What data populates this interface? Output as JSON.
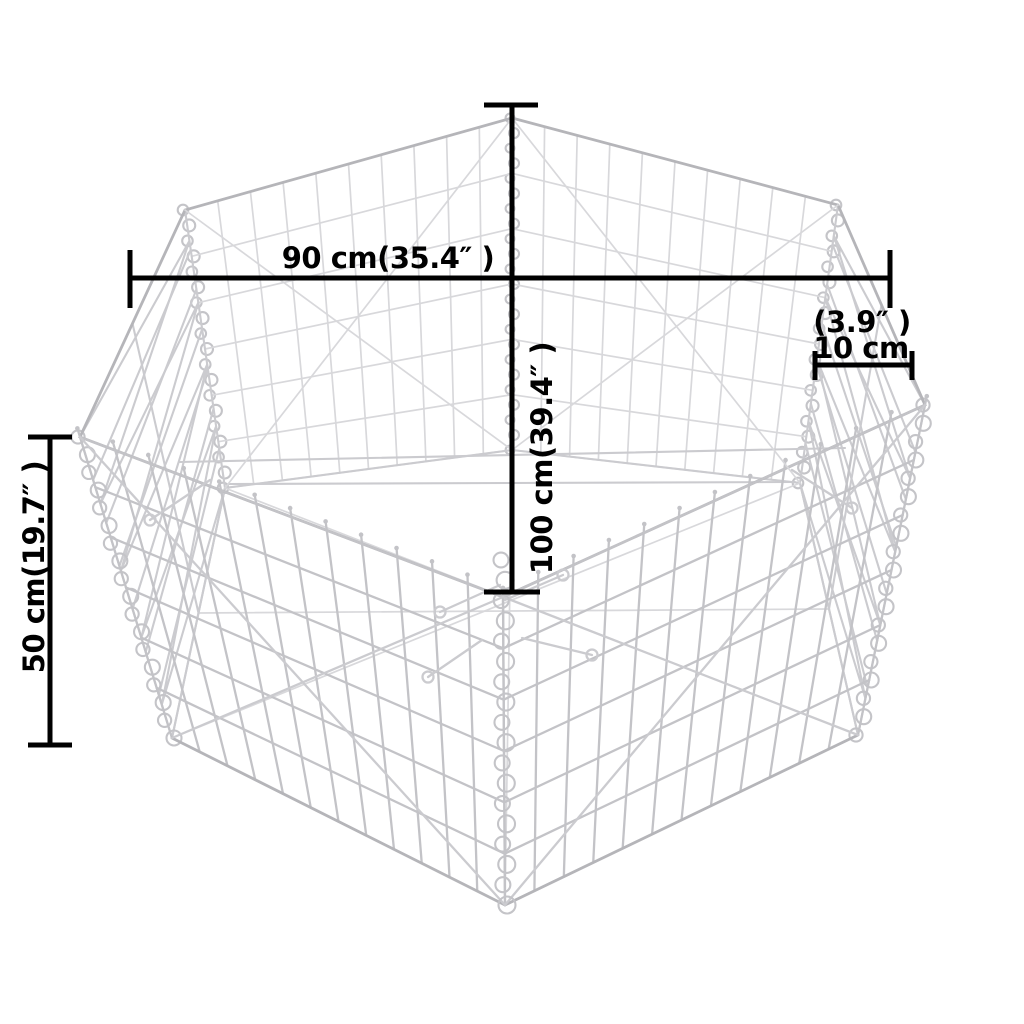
{
  "figure": {
    "type": "product-dimension-diagram",
    "subject": "hexagonal-gabion-wire-mesh-basket",
    "background_color": "#ffffff",
    "wire_color_near": "#c3c3c7",
    "wire_color_mid": "#cbcbcf",
    "wire_color_far": "#d8d8db",
    "wire_color_rim": "#b5b5b9",
    "spiral_color": "#c4c4c8",
    "dimension_color": "#000000"
  },
  "dimensions": {
    "width": {
      "label": "90 cm(35.4″ )",
      "value_cm": 90,
      "value_inch": 35.4,
      "orientation": "horizontal"
    },
    "depth": {
      "label": "100 cm(39.4″ )",
      "value_cm": 100,
      "value_inch": 39.4,
      "orientation": "vertical-rotated"
    },
    "height": {
      "label": "50 cm(19.7″ )",
      "value_cm": 50,
      "value_inch": 19.7,
      "orientation": "vertical-rotated"
    },
    "side": {
      "label_inch": "(3.9″ )",
      "label_cm": "10 cm",
      "value_cm": 10,
      "value_inch": 3.9,
      "orientation": "horizontal"
    }
  }
}
